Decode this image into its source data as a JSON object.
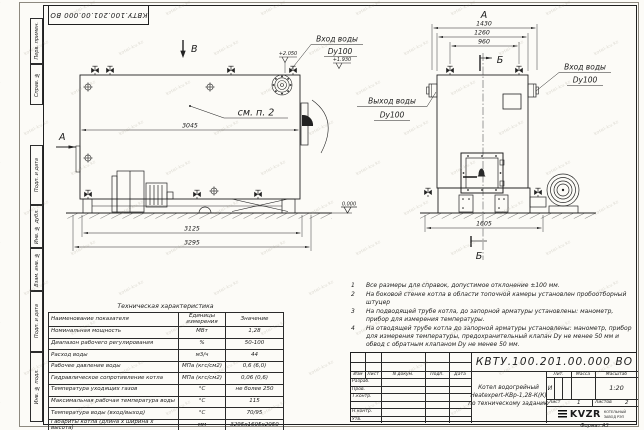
{
  "doc_number": "КВТУ.100.201.00.000 ВО",
  "watermark": "kotel-kv.kz",
  "margin_labels": [
    "Перв. примен.",
    "Справ. №",
    "Подп. и дата",
    "Инв. № дубл.",
    "Взам. инв. №",
    "Подп. и дата",
    "Инв. № подл."
  ],
  "views": {
    "side": {
      "label_b": "В",
      "label_a": "А",
      "dim_body": "3045",
      "dim_frame": "3125",
      "dim_overall": "3295",
      "callout": "см. п. 2",
      "elev_top": "+2.050",
      "elev_nozzle": "+1.930",
      "elev_ground": "0.000",
      "inlet_label": "Вход воды",
      "inlet_dn": "Dy100"
    },
    "front": {
      "label": "А",
      "dim_overall": "1430",
      "dim_mid": "1260",
      "dim_valves": "960",
      "dim_base": "1605",
      "section_top": "Б",
      "section_bottom": "Б",
      "outlet_label": "Выход воды",
      "outlet_dn": "Dy100",
      "inlet_label": "Вход воды",
      "inlet_dn": "Dy100"
    }
  },
  "notes": [
    {
      "num": "1",
      "text": "Все размеры для справок, допустимое отклонение ±100 мм."
    },
    {
      "num": "2",
      "text": "На боковой стенке котла в области топочной камеры установлен пробоотборный штуцер"
    },
    {
      "num": "3",
      "text": "На подводящей трубе котла, до запорной арматуры установлены: манометр, прибор для измерения температуры."
    },
    {
      "num": "4",
      "text": "На отводящей трубе котла до запорной арматуры установлены: манометр, прибор для измерения температуры, предохранительный клапан Dy не менее 50 мм и обвод с обратным клапаном Dy не менее 50 мм."
    }
  ],
  "tech_table": {
    "title": "Техническая характеристика",
    "headers": [
      "Наименование показателя",
      "Единицы измерения",
      "Значение"
    ],
    "rows": [
      {
        "name": "Номинальная мощность",
        "unit": "МВт",
        "value": "1,28"
      },
      {
        "name": "Диапазон рабочего регулирования",
        "unit": "%",
        "value": "50-100"
      },
      {
        "name": "Расход воды",
        "unit": "м3/ч",
        "value": "44"
      },
      {
        "name": "Рабочее давление воды",
        "unit": "МПа (кгс/см2)",
        "value": "0,6 (6,0)"
      },
      {
        "name": "Гидравлическое сопротивление котла",
        "unit": "МПа (кгс/см2)",
        "value": "0,06 (0,6)"
      },
      {
        "name": "Температура уходящих газов",
        "unit": "°С",
        "value": "не более 250"
      },
      {
        "name": "Максимальная рабочая температура воды",
        "unit": "°С",
        "value": "115"
      },
      {
        "name": "Температура воды (вход/выход)",
        "unit": "°С",
        "value": "70/95"
      },
      {
        "name": "Габариты котла (длина х ширина х высота)",
        "unit": "мм",
        "value": "3295х1605х2050"
      }
    ]
  },
  "title_block": {
    "sign_cols": [
      "Изм",
      "Лист",
      "N докум.",
      "Подп.",
      "Дата"
    ],
    "sign_rows": [
      "Разраб.",
      "Пров.",
      "Т.контр.",
      "Н.контр.",
      "Утв."
    ],
    "product_title_lines": [
      "Котел водогрейный",
      "Heatexpert-КВр-1,28-К(К)",
      "по техническому заданию"
    ],
    "lit_label": "Лит.",
    "mass_label": "Масса",
    "scale_label": "Масштаб",
    "lit_value": "И",
    "scale_value": "1:20",
    "sheet_label": "Лист",
    "sheet_value": "1",
    "sheets_label": "Листов",
    "sheets_value": "2",
    "org": {
      "logo": "KVZR",
      "line1": "КОТЕЛЬНЫЙ",
      "line2": "ЗАВОД РЭП"
    },
    "format": "Формат А3"
  }
}
